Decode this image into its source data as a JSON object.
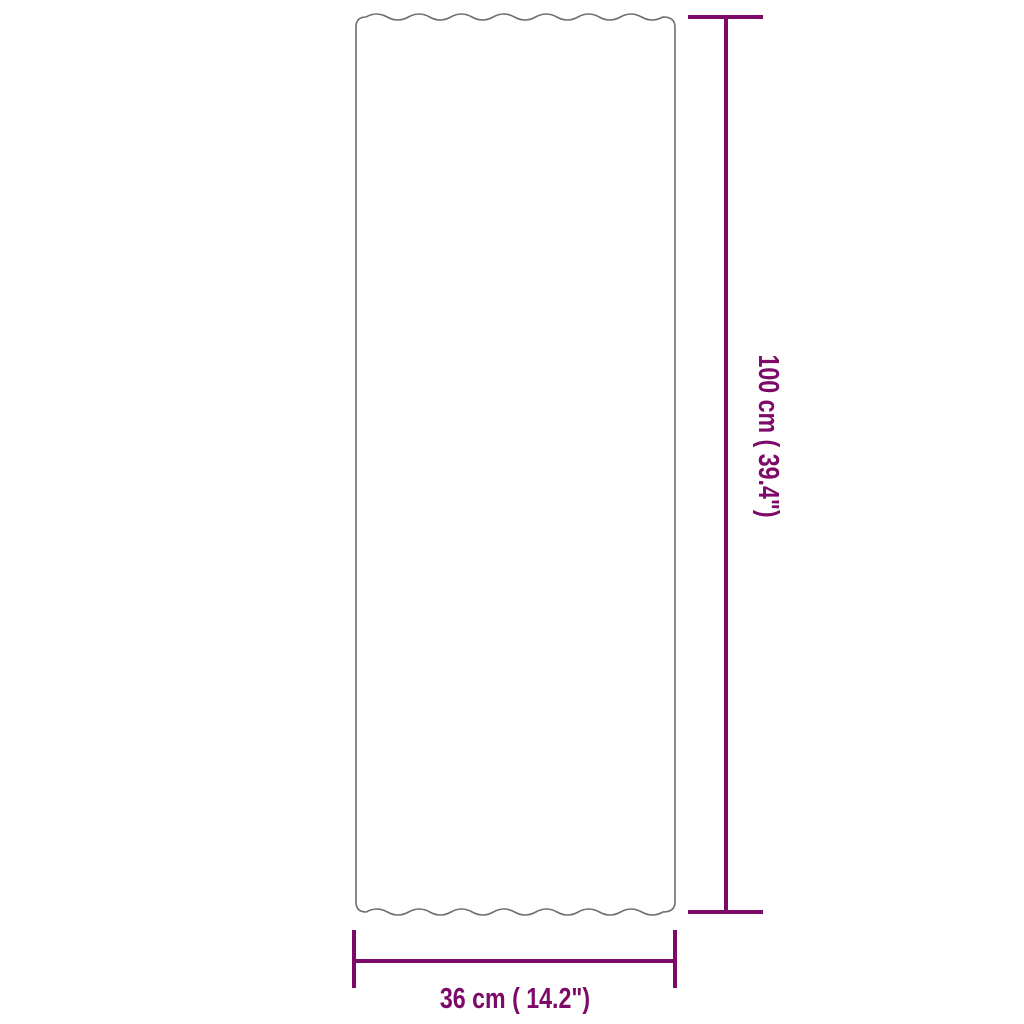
{
  "diagram": {
    "height_dimension": {
      "label": "100 cm ( 39.4\")"
    },
    "width_dimension": {
      "label": "36 cm ( 14.2\")"
    }
  },
  "colors": {
    "dimension_accent": "#7d0a68",
    "panel_outline": "#6e6e6e",
    "background": "#ffffff"
  }
}
